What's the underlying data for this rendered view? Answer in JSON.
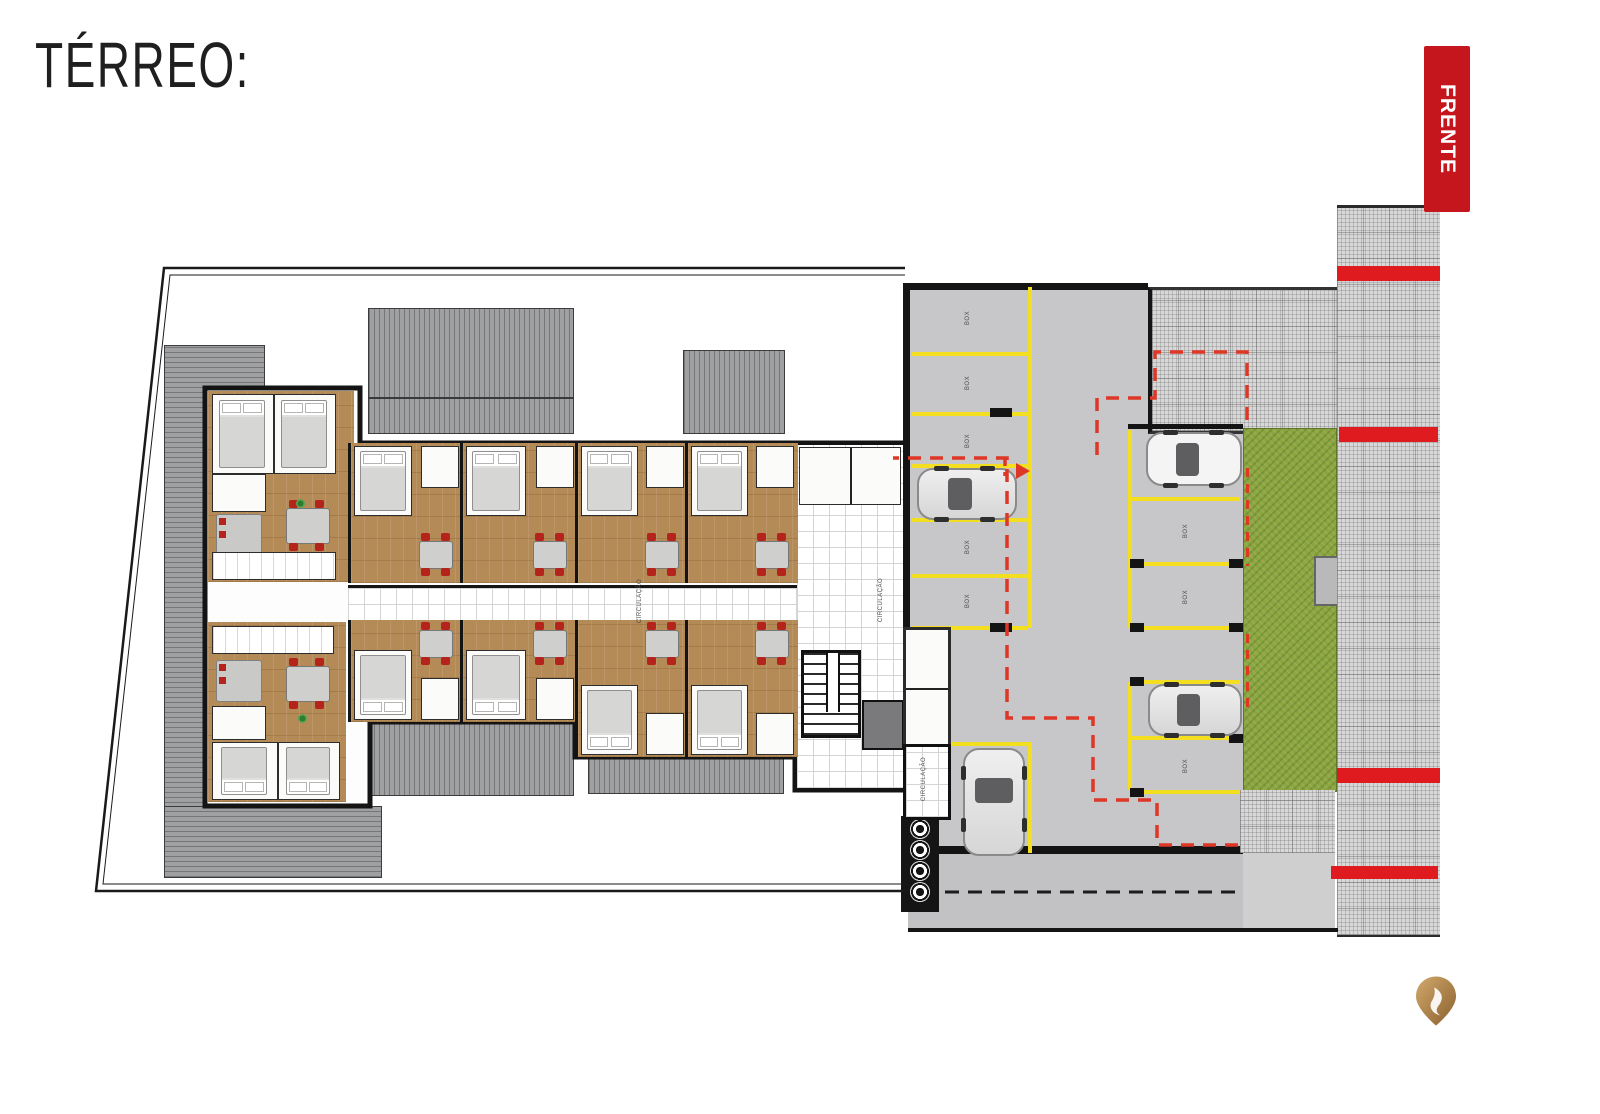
{
  "page": {
    "title": "TÉRREO:"
  },
  "front_badge": {
    "label": "FRENTE",
    "color": "#c4161c"
  },
  "plan_labels": {
    "circulation": "CIRCULAÇÃO",
    "parking_box": "BOX"
  },
  "garage": {
    "parking_boxes": 12,
    "empty_boxes": 8,
    "parked_cars": 4
  },
  "colors": {
    "parking_line_yellow": "#f3df1f",
    "route_dash_red": "#de3726",
    "sidewalk_stripe_red": "#e01b1f",
    "lawn_green": "#8ba53f",
    "wood_floor": "#b48a57",
    "roof_gray": "#9fa0a2",
    "logo_gold": "#b9894d"
  }
}
